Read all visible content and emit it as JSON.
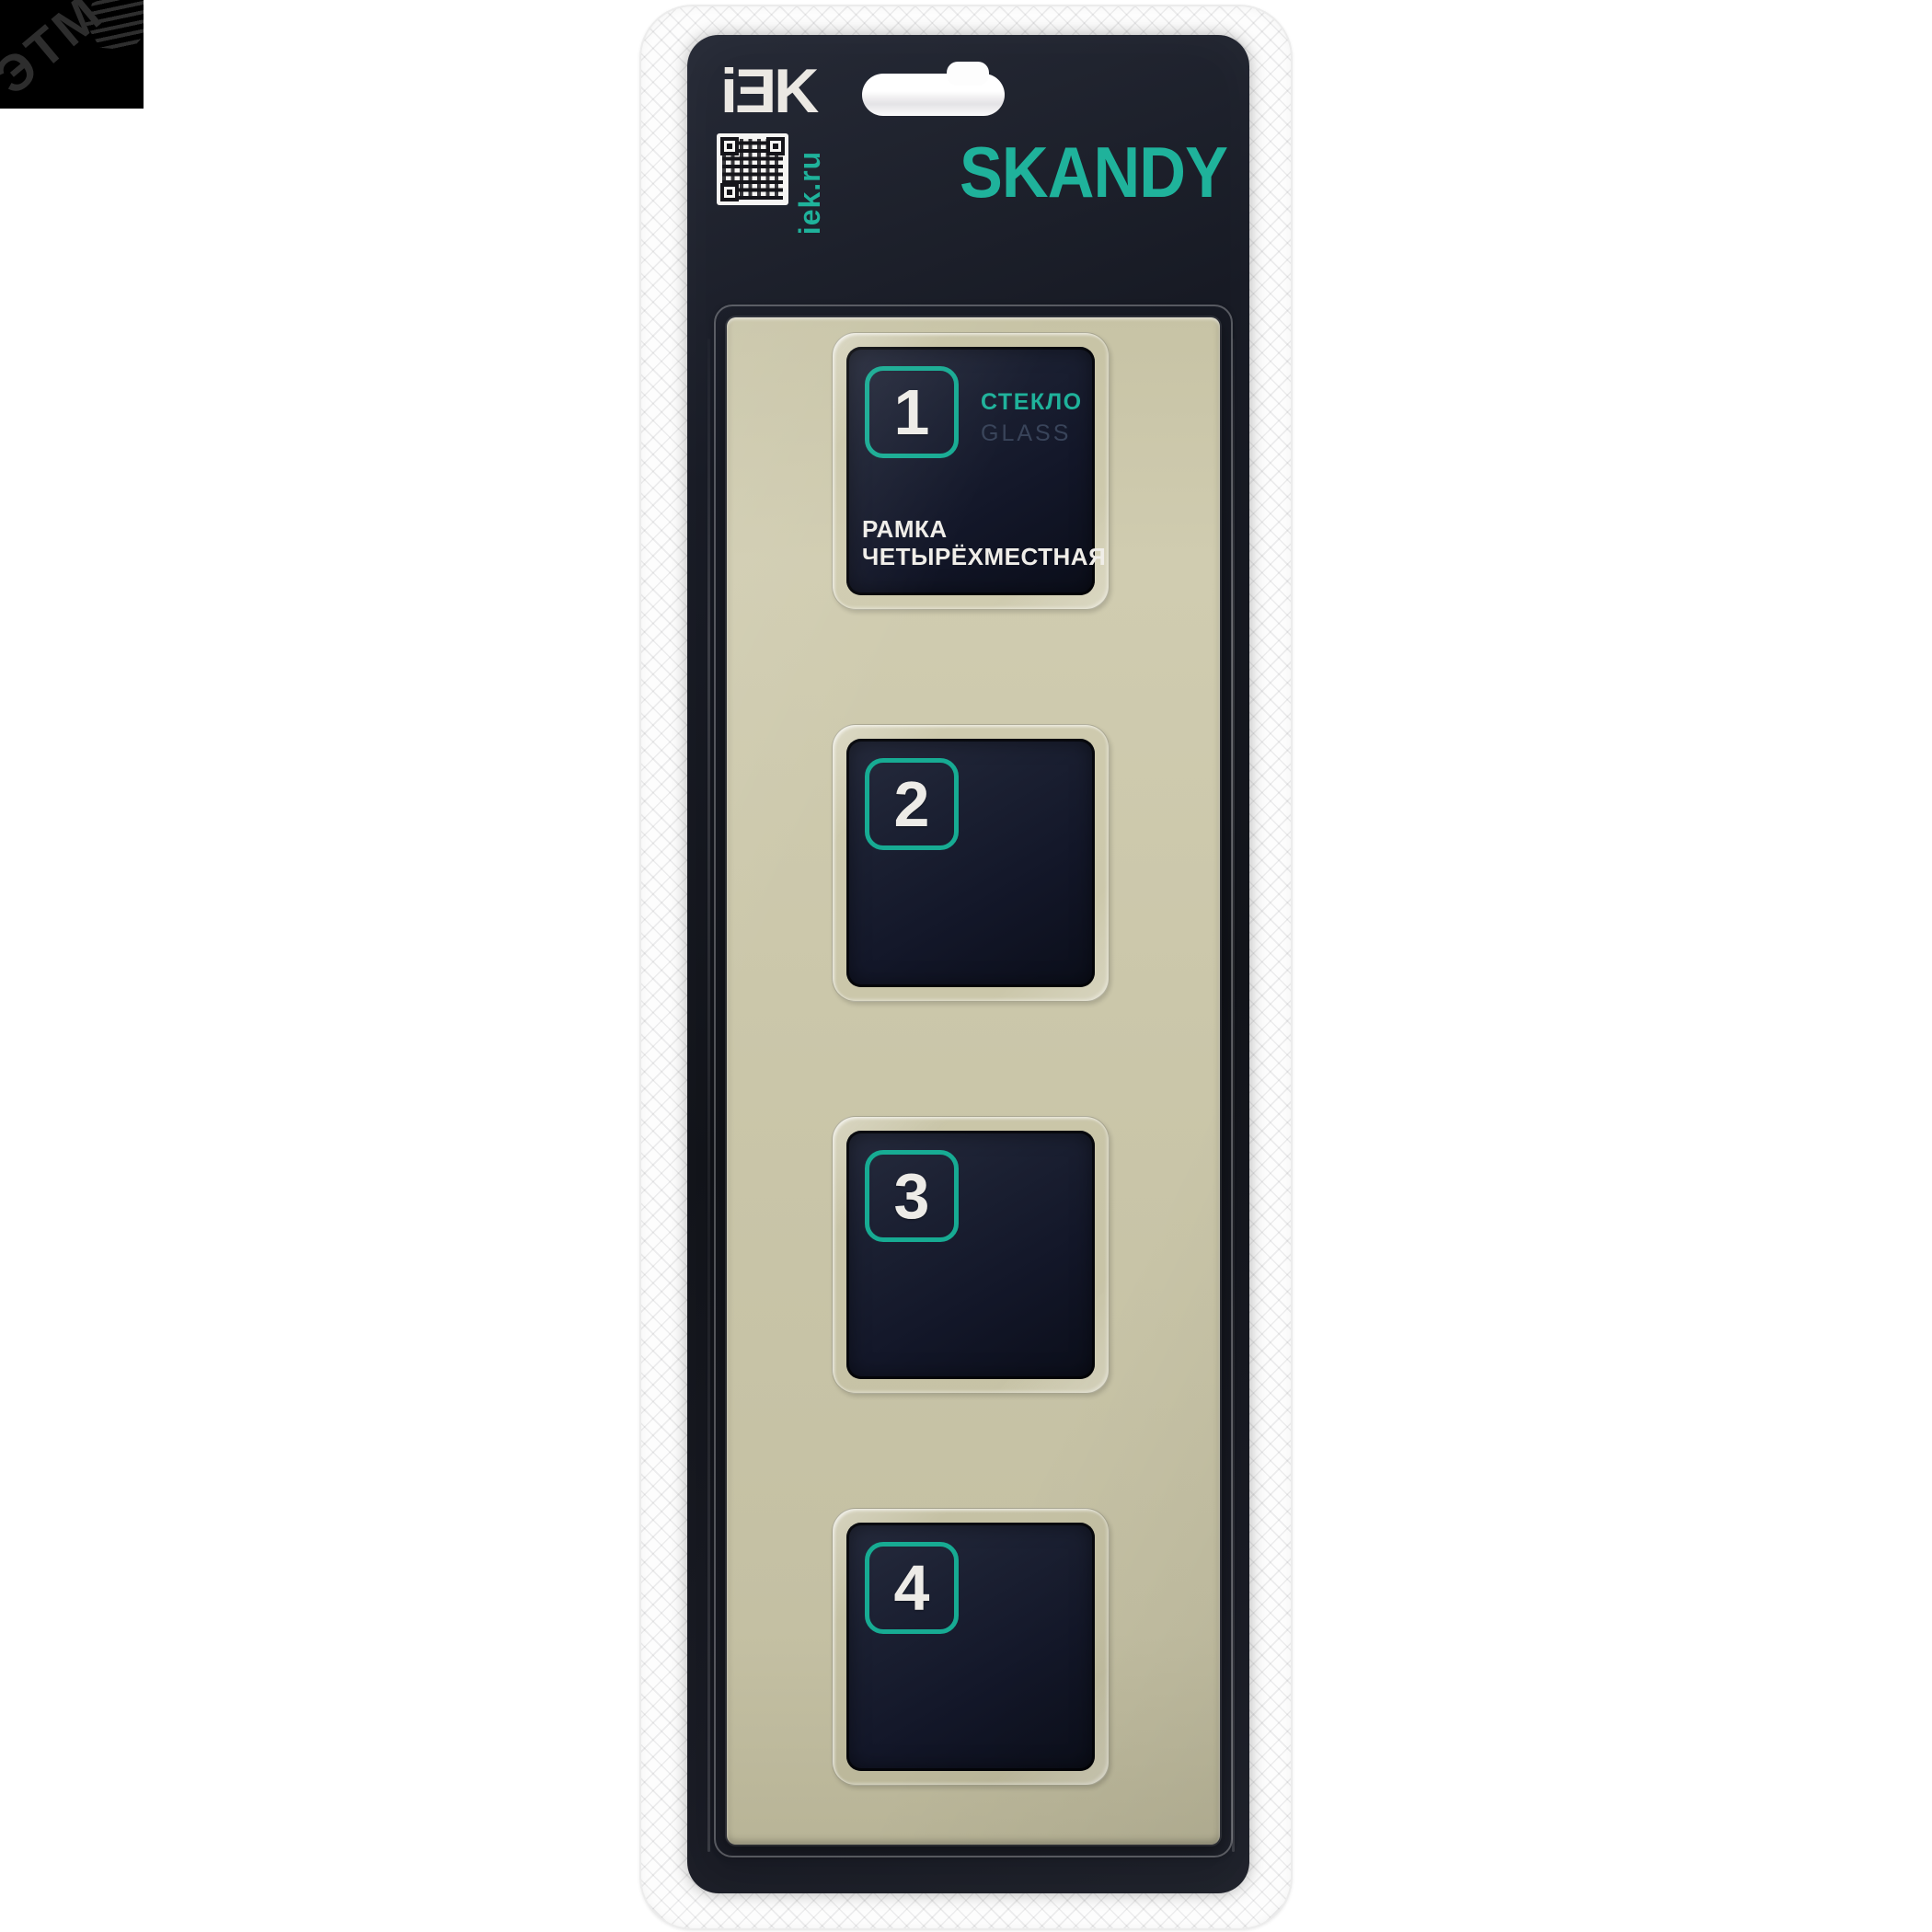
{
  "watermark": {
    "text": "ЭТМ"
  },
  "header": {
    "brand": "iƎK",
    "site": "iek.ru",
    "series": "SKANDY"
  },
  "product": {
    "material_ru": "СТЕКЛО",
    "material_en": "GLASS",
    "name_line1": "РАМКА",
    "name_line2": "ЧЕТЫРЁХМЕСТНАЯ"
  },
  "windows": [
    {
      "number": "1"
    },
    {
      "number": "2"
    },
    {
      "number": "3"
    },
    {
      "number": "4"
    }
  ],
  "colors": {
    "accent": "#1fb29b",
    "card": "#14161f",
    "frame": "#c9c5a8",
    "window": "#141828",
    "muted_label": "#39445a"
  }
}
